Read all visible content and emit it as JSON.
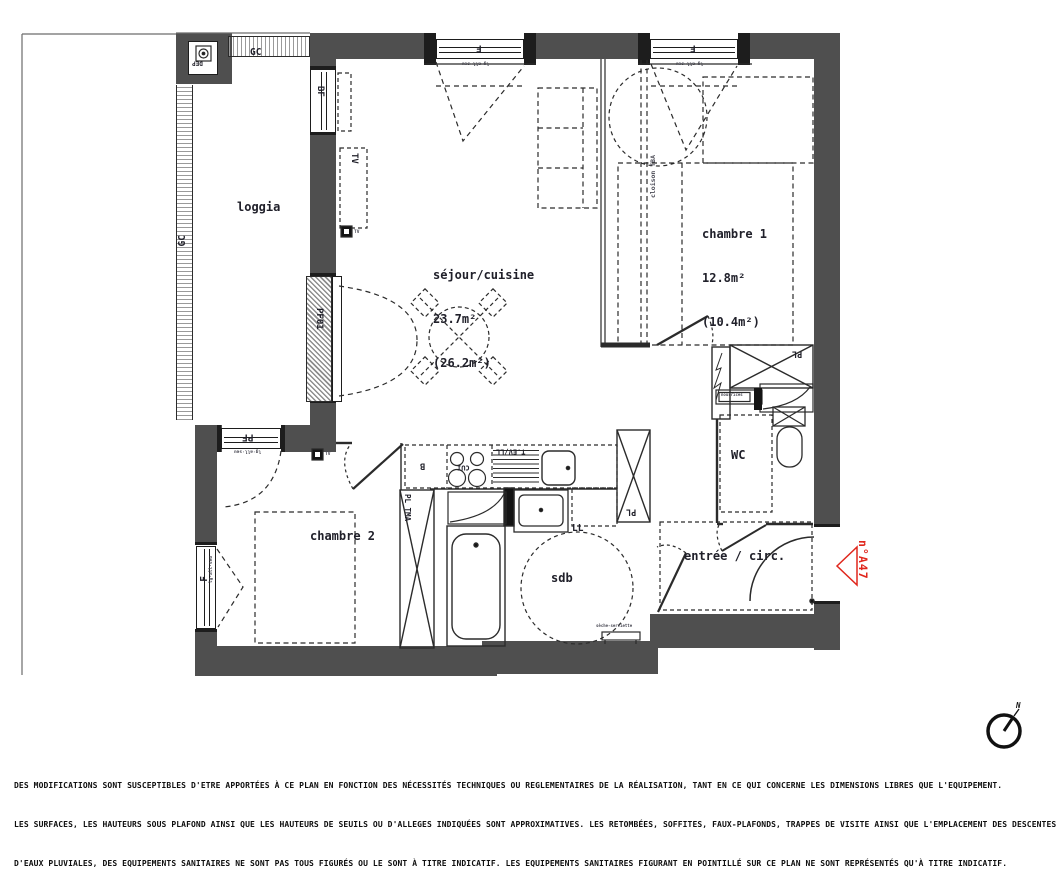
{
  "unit": {
    "number": "n°A47"
  },
  "rooms": {
    "loggia": {
      "name": "loggia"
    },
    "sejour": {
      "name": "séjour/cuisine",
      "area": "23.7m²",
      "area_shab": "(26.2m²)"
    },
    "chambre1": {
      "name": "chambre 1",
      "area": "12.8m²",
      "area_shab": "(10.4m²)"
    },
    "chambre2": {
      "name": "chambre 2"
    },
    "wc": {
      "name": "WC"
    },
    "sdb": {
      "name": "sdb"
    },
    "entree": {
      "name": "entrée / circ."
    }
  },
  "labels": {
    "gc": "GC",
    "dep": "DEP",
    "bf": "BF",
    "tv": "TV",
    "pf01": "PF01",
    "pf": "PF",
    "f": "F",
    "b": "B",
    "cui": "CUI",
    "t_ev_ll": "T.EV/LL",
    "pl": "PL",
    "pl_tma": "PL TMA",
    "ll": "LL",
    "nourrices": "nourrices",
    "seche_serviette": "sèche-serviette",
    "cloison_tba": "cloison TBA",
    "window_dims": "lg·all·seu"
  },
  "compass": {
    "north": "N"
  },
  "colors": {
    "wall": "#4f4f4f",
    "accent_red": "#e0261c",
    "line": "#2b2b2b"
  },
  "footer": {
    "line1": "DES MODIFICATIONS SONT SUSCEPTIBLES D'ETRE APPORTÉES À CE PLAN EN FONCTION DES NÉCESSITÉS TECHNIQUES OU REGLEMENTAIRES DE LA RÉALISATION, TANT EN CE QUI CONCERNE LES DIMENSIONS LIBRES QUE L'EQUIPEMENT.",
    "line2": "LES SURFACES, LES HAUTEURS SOUS PLAFOND AINSI QUE LES HAUTEURS DE SEUILS OU D'ALLEGES INDIQUÉES SONT APPROXIMATIVES. LES RETOMBÉES, SOFFITES, FAUX-PLAFONDS, TRAPPES DE VISITE AINSI QUE L'EMPLACEMENT DES DESCENTES",
    "line3": "D'EAUX PLUVIALES, DES EQUIPEMENTS SANITAIRES NE SONT PAS TOUS FIGURÉS OU LE SONT À TITRE INDICATIF. LES EQUIPEMENTS SANITAIRES FIGURANT EN POINTILLÉ SUR CE PLAN NE SONT REPRÉSENTÉS QU'À TITRE INDICATIF."
  }
}
